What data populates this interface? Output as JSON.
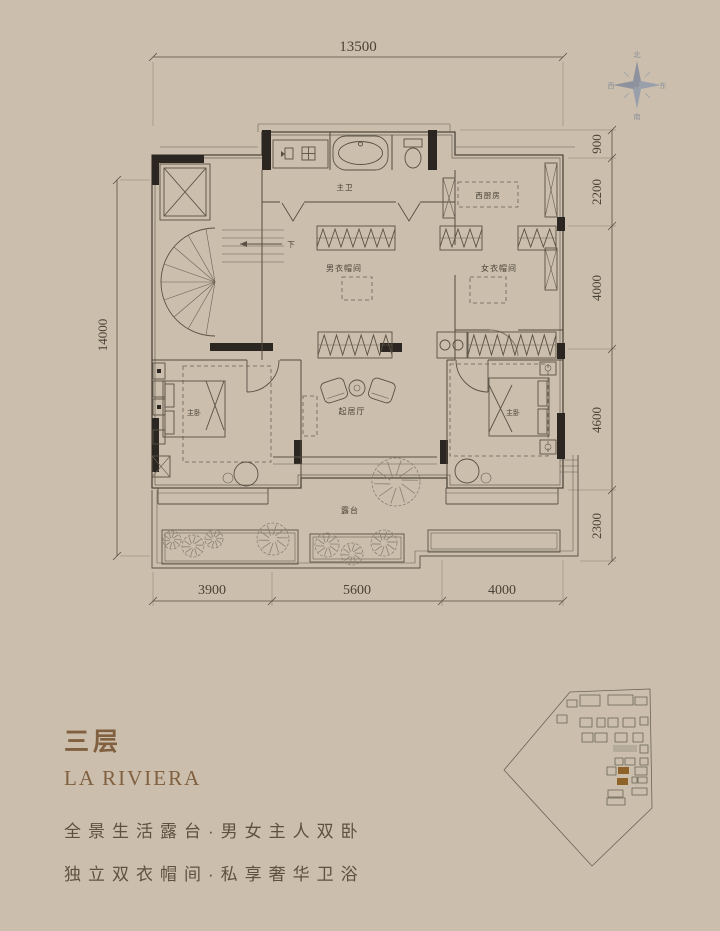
{
  "plan": {
    "dimensions": {
      "top": "13500",
      "left": "14000",
      "right": [
        "900",
        "2200",
        "4000",
        "4600",
        "2300"
      ],
      "bottom": [
        "3900",
        "5600",
        "4000"
      ]
    },
    "compass": {
      "north": "北",
      "south": "南",
      "east": "东",
      "west": "西"
    },
    "rooms": {
      "master_bath": "主卫",
      "west_kitchen": "西厨房",
      "mens_closet": "男衣帽间",
      "womens_closet": "女衣帽间",
      "living_room": "起居厅",
      "master_bedroom_left": "主卧",
      "master_bedroom_right": "主卧",
      "terrace": "露台",
      "stair_down": "下"
    },
    "colors": {
      "line": "#4f473c",
      "wall_fill": "#2b2621",
      "dim_text": "#4c4337"
    }
  },
  "info": {
    "floor_title": "三层",
    "project_name": "LA RIVIERA",
    "feature_line1": "全景生活露台·男女主人双卧",
    "feature_line2": "独立双衣帽间·私享奢华卫浴",
    "accent_color": "#80603f"
  },
  "siteplan": {
    "highlight_color": "#8f6327"
  }
}
